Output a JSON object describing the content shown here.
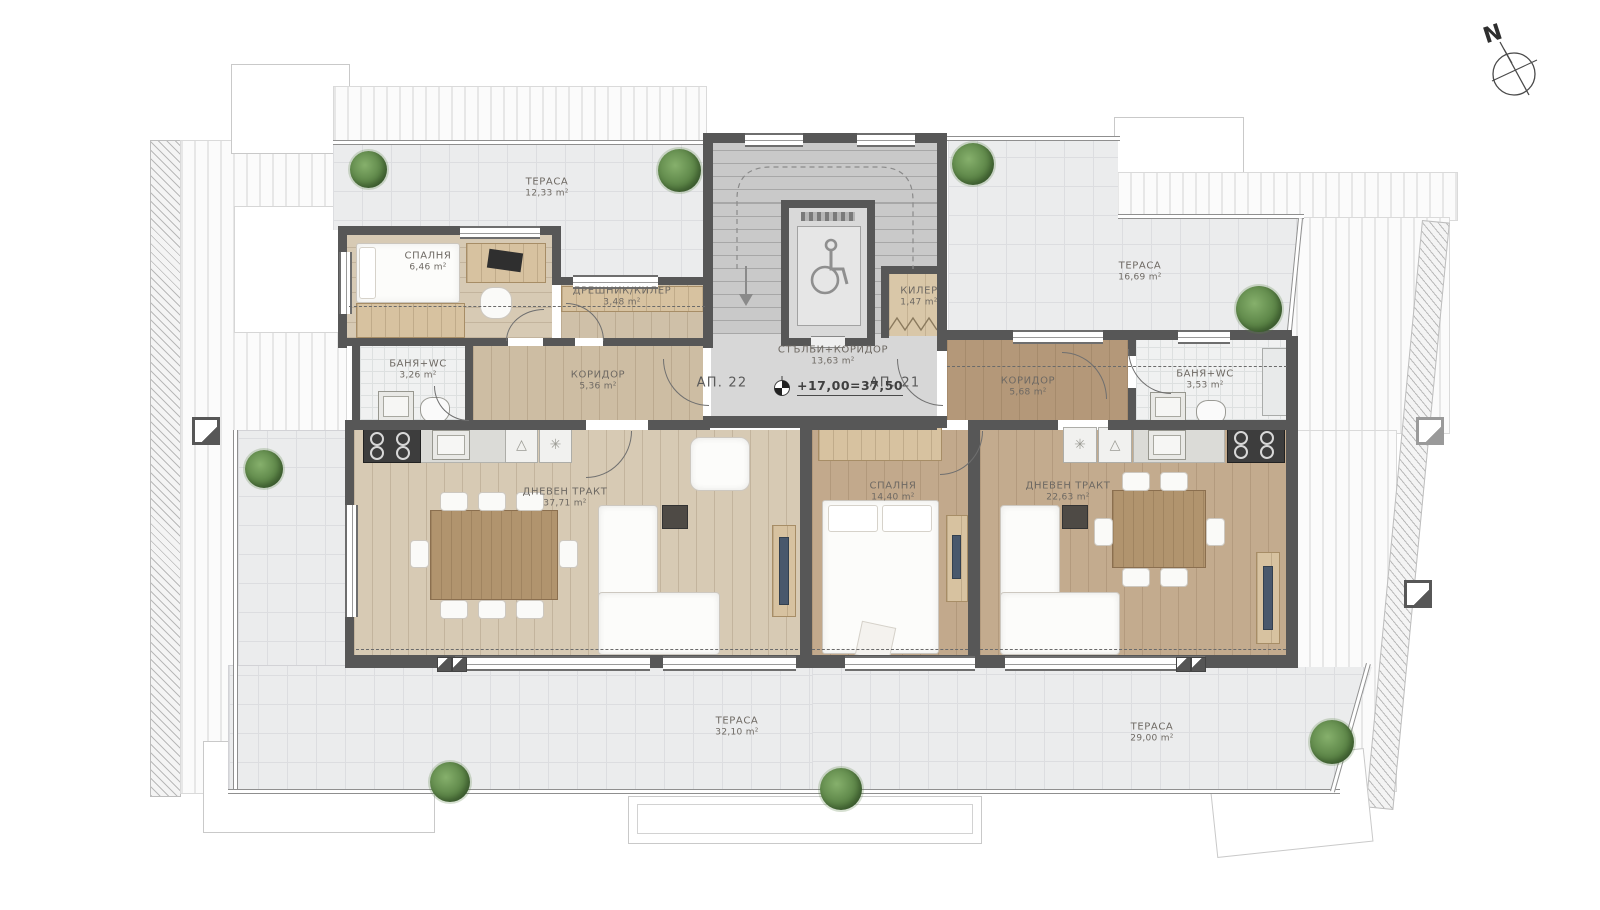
{
  "compass": {
    "north": "N"
  },
  "apartments": {
    "left": "АП. 22",
    "right": "АП. 21"
  },
  "level_mark": {
    "text": "+17,00=37,50"
  },
  "rooms": {
    "terrace_top_left": {
      "name": "ТЕРАСА",
      "area": "12,33 m²"
    },
    "terrace_top_right": {
      "name": "ТЕРАСА",
      "area": "16,69 m²"
    },
    "terrace_bottom_left": {
      "name": "ТЕРАСА",
      "area": "32,10 m²"
    },
    "terrace_bottom_right": {
      "name": "ТЕРАСА",
      "area": "29,00 m²"
    },
    "bedroom_left": {
      "name": "СПАЛНЯ",
      "area": "6,46 m²"
    },
    "dressing_left": {
      "name": "ДРЕШНИК/КИЛЕР",
      "area": "3,48 m²"
    },
    "bath_left": {
      "name": "БАНЯ+WC",
      "area": "3,26 m²"
    },
    "corridor_left": {
      "name": "КОРИДОР",
      "area": "5,36 m²"
    },
    "living_left": {
      "name": "ДНЕВЕН ТРАКТ",
      "area": "37,71 m²"
    },
    "stairs_corridor": {
      "name": "СТЪЛБИ+КОРИДОР",
      "area": "13,63 m²"
    },
    "closet_core": {
      "name": "КИЛЕР",
      "area": "1,47 m²"
    },
    "corridor_right": {
      "name": "КОРИДОР",
      "area": "5,68 m²"
    },
    "bath_right": {
      "name": "БАНЯ+WC",
      "area": "3,53 m²"
    },
    "bedroom_right": {
      "name": "СПАЛНЯ",
      "area": "14,40 m²"
    },
    "living_right": {
      "name": "ДНЕВЕН ТРАКТ",
      "area": "22,63 m²"
    }
  },
  "colors": {
    "wall": "#575757",
    "wood_light": "#d7cab4",
    "wood_mid": "#c2a98c",
    "wood_dark": "#b49879",
    "terrace_tile": "#ebeced",
    "plant": "#567f42",
    "tv_accent": "#49586c"
  }
}
